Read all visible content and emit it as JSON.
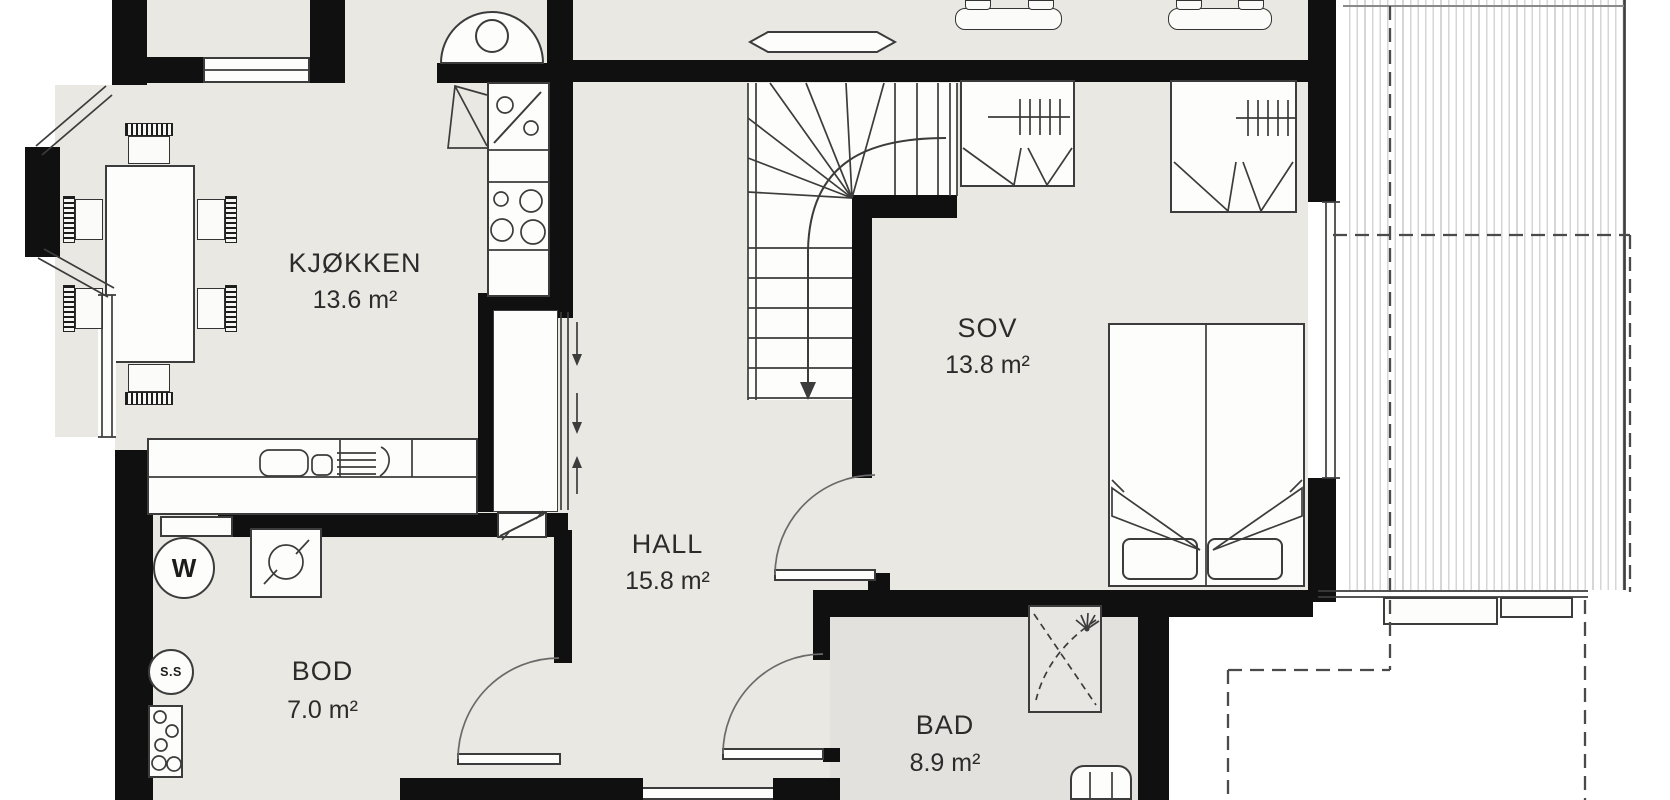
{
  "rooms": [
    {
      "id": "kjokken",
      "name": "KJØKKEN",
      "area": "13.6 m²"
    },
    {
      "id": "sov",
      "name": "SOV",
      "area": "13.8 m²"
    },
    {
      "id": "hall",
      "name": "HALL",
      "area": "15.8 m²"
    },
    {
      "id": "bod",
      "name": "BOD",
      "area": "7.0 m²"
    },
    {
      "id": "bad",
      "name": "BAD",
      "area": "8.9 m²"
    }
  ],
  "fixtures": {
    "water_heater_label": "W",
    "floor_drain_label": "S.S"
  },
  "colors": {
    "wall": "#101010",
    "floor": "#eae8e3",
    "bath_floor": "#e2e1de",
    "line": "#3c3c3c",
    "outside": "#ffffff"
  }
}
